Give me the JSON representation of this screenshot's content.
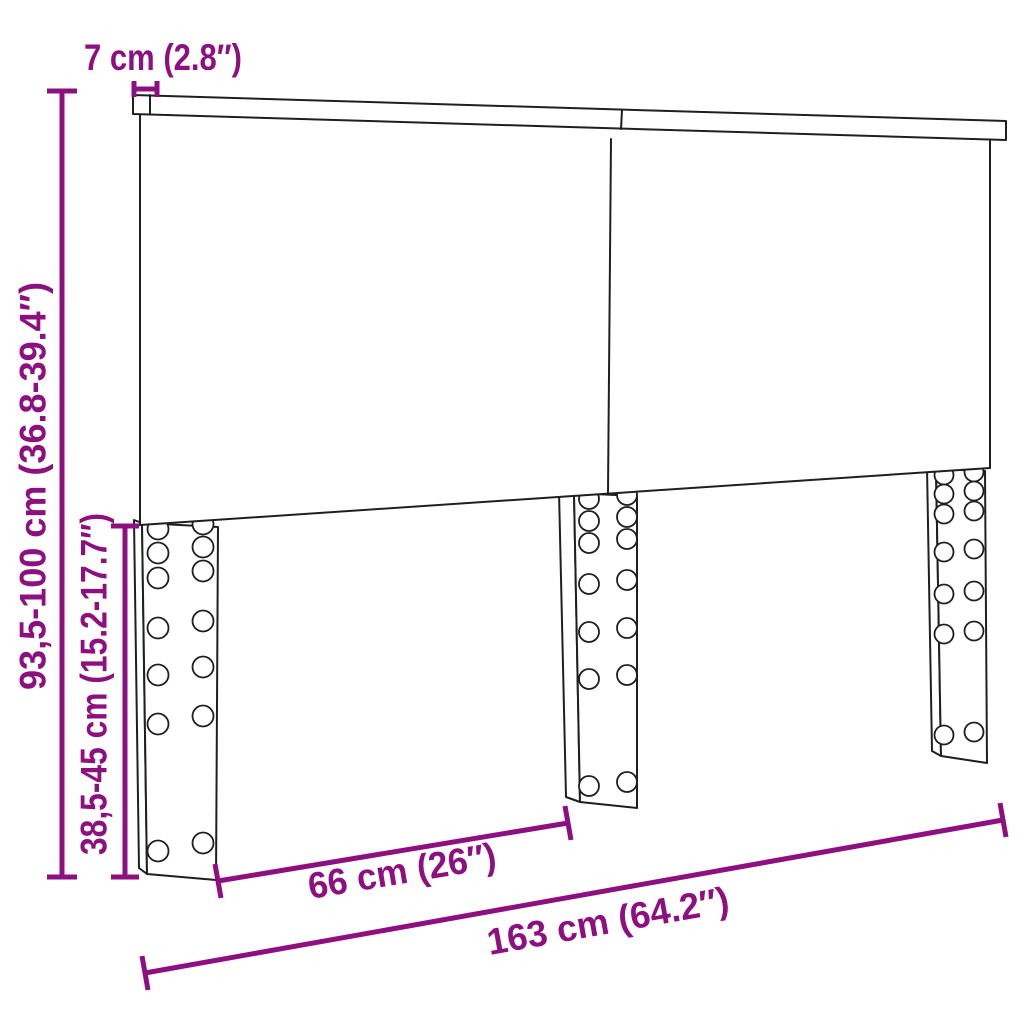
{
  "colors": {
    "accent": "#8E1080",
    "line": "#1F1F1F"
  },
  "diagram": {
    "dimensions": {
      "top_thickness": "7 cm (2.8″)",
      "overall_height": "93,5-100 cm (36.8-39.4″)",
      "leg_height": "38,5-45 cm (15.2-17.7″)",
      "leg_spacing": "66 cm (26″)",
      "overall_width": "163 cm (64.2″)"
    }
  }
}
